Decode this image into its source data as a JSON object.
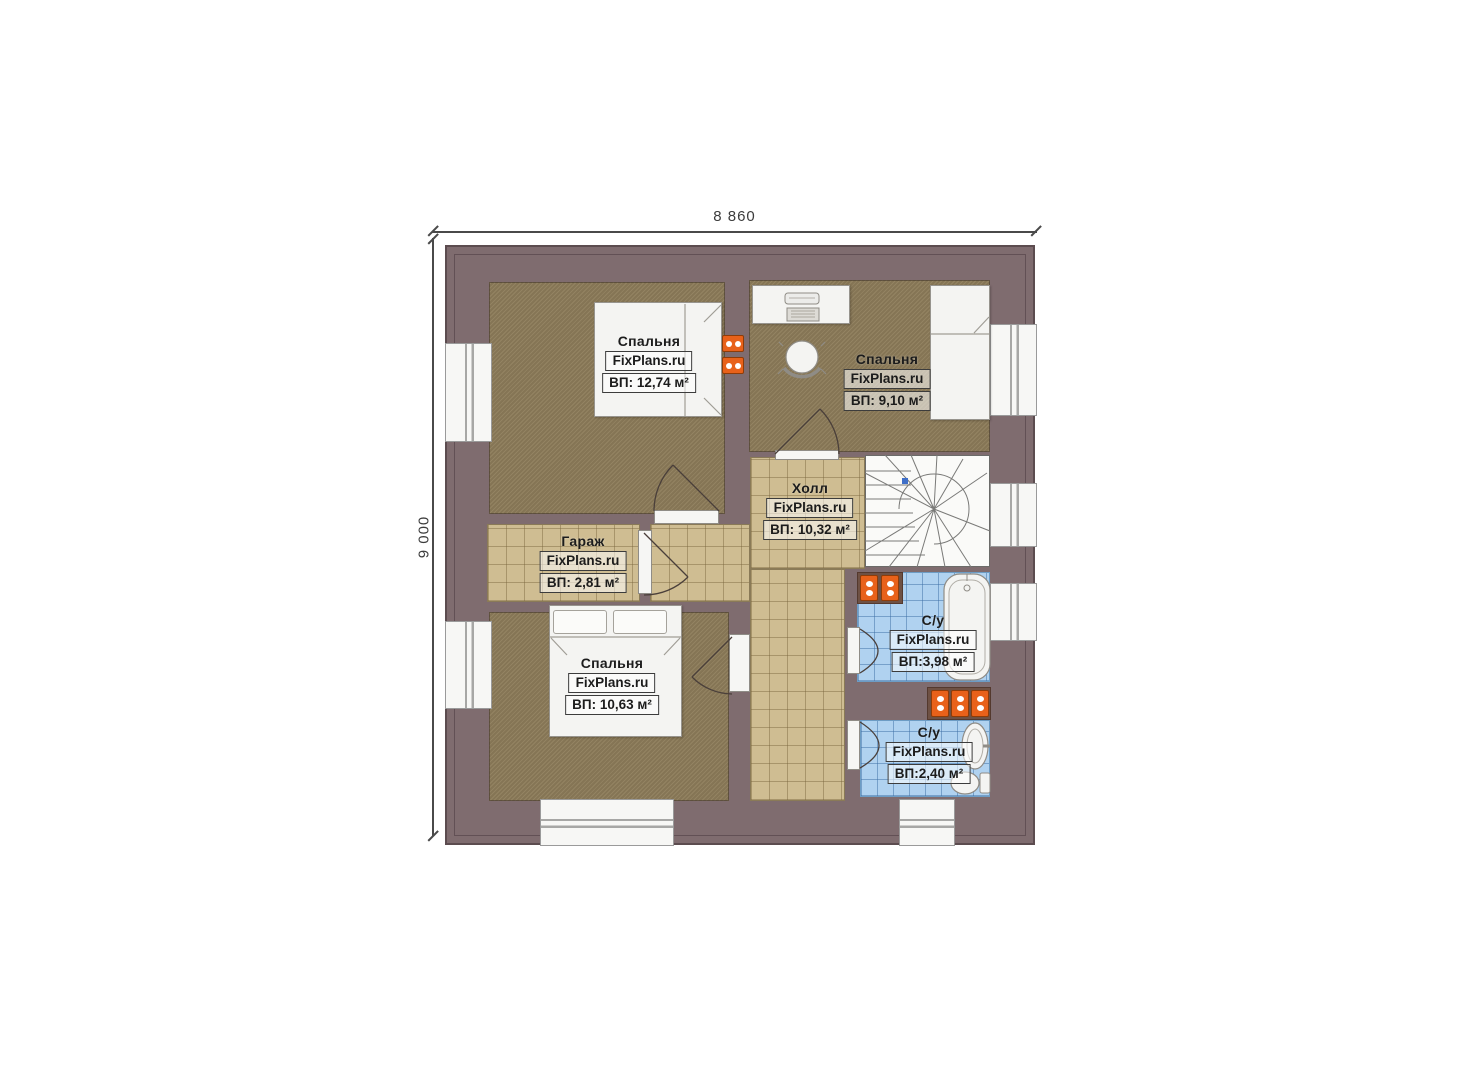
{
  "dimensions": {
    "top": "8 860",
    "left": "9 000"
  },
  "brand": "FixPlans.ru",
  "rooms": [
    {
      "id": "bedroom-top-left",
      "name": "Спальня",
      "brand": "FixPlans.ru",
      "area": "ВП: 12,74 м²"
    },
    {
      "id": "bedroom-top-right",
      "name": "Спальня",
      "brand": "FixPlans.ru",
      "area": "ВП: 9,10 м²"
    },
    {
      "id": "hall",
      "name": "Холл",
      "brand": "FixPlans.ru",
      "area": "ВП: 10,32 м²"
    },
    {
      "id": "garage",
      "name": "Гараж",
      "brand": "FixPlans.ru",
      "area": "ВП: 2,81 м²"
    },
    {
      "id": "bedroom-bottom-left",
      "name": "Спальня",
      "brand": "FixPlans.ru",
      "area": "ВП: 10,63 м²"
    },
    {
      "id": "bathroom-upper",
      "name": "С/у",
      "brand": "FixPlans.ru",
      "area": "ВП:3,98 м²"
    },
    {
      "id": "bathroom-lower",
      "name": "С/у",
      "brand": "FixPlans.ru",
      "area": "ВП:2,40 м²"
    }
  ],
  "colors": {
    "wall": "#7f6c6f",
    "bedroom_floor": "#8d7c5a",
    "tile_floor": "#cfbd92",
    "bath_tile": "#b0d2f0",
    "fixture_white": "#f4f4f2",
    "radiator_orange": "#e8611a",
    "stair_marker_blue": "#3f6fc8"
  }
}
